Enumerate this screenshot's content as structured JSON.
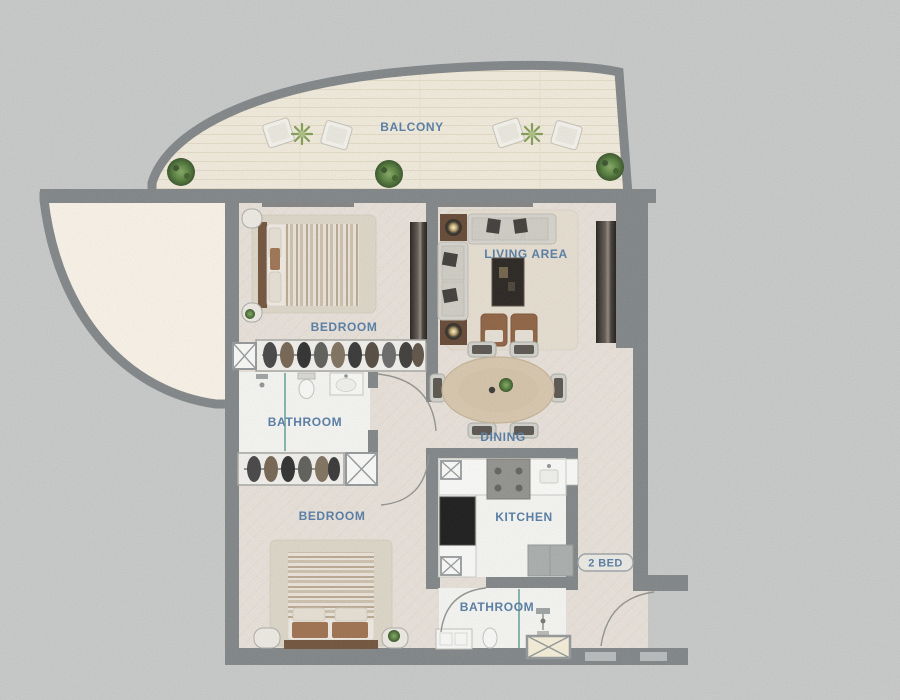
{
  "labels": {
    "balcony": "BALCONY",
    "bedroom1": "BEDROOM",
    "living": "LIVING AREA",
    "bathroom1": "BATHROOM",
    "dining": "DINING",
    "bedroom2": "BEDROOM",
    "kitchen": "KITCHEN",
    "bathroom2": "BATHROOM",
    "unit_badge": "2 BED"
  },
  "colors": {
    "background": "#c7c8c8",
    "wall": "#7b8082",
    "label_text": "#4d76a1",
    "balcony_floor": "#f4edde",
    "terrace_floor": "#fcf5e9",
    "interior_floor": "#e9e2da",
    "wet_room_floor": "#f8f8f5",
    "glass_divider": "#7fb3a8",
    "wood_furniture": "#8a5a38",
    "shaft_box_fill": "#fdfdfb"
  }
}
